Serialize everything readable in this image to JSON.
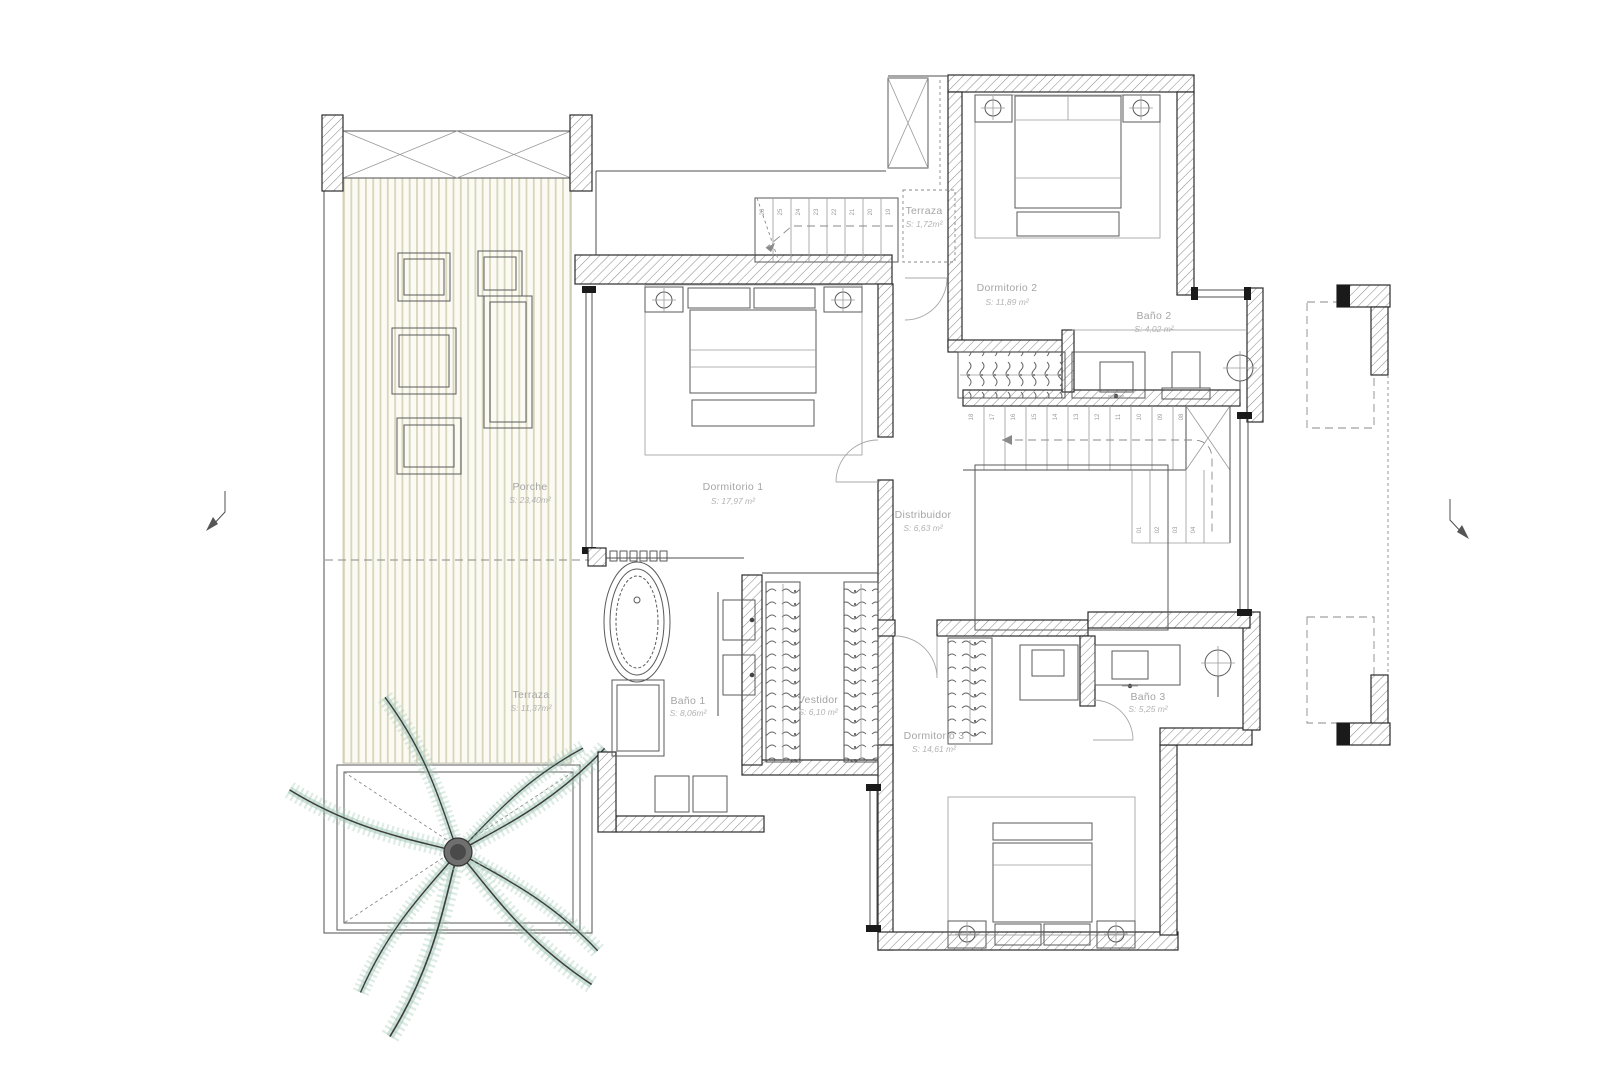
{
  "plan": {
    "rooms": [
      {
        "id": "porche",
        "label": "Porche",
        "area": "S: 23,40m²"
      },
      {
        "id": "terraza-izq",
        "label": "Terraza",
        "area": "S: 11,37m²"
      },
      {
        "id": "dormitorio-1",
        "label": "Dormitorio 1",
        "area": "S: 17,97 m²"
      },
      {
        "id": "bano-1",
        "label": "Baño 1",
        "area": "S: 8,06m²"
      },
      {
        "id": "vestidor",
        "label": "Vestidor",
        "area": "S: 6,10 m²"
      },
      {
        "id": "distribuidor",
        "label": "Distribuidor",
        "area": "S: 6,63 m²"
      },
      {
        "id": "terraza-sup",
        "label": "Terraza",
        "area": "S: 1,72m²"
      },
      {
        "id": "dormitorio-2",
        "label": "Dormitorio 2",
        "area": "S: 11,89 m²"
      },
      {
        "id": "bano-2",
        "label": "Baño 2",
        "area": "S: 4,02 m²"
      },
      {
        "id": "dormitorio-3",
        "label": "Dormitorio 3",
        "area": "S: 14,61 m²"
      },
      {
        "id": "bano-3",
        "label": "Baño 3",
        "area": "S: 5,25 m²"
      }
    ],
    "stairs": {
      "exterior_steps": [
        "26",
        "25",
        "24",
        "23",
        "22",
        "21",
        "20",
        "19"
      ],
      "upper_flight_steps": [
        "18",
        "17",
        "16",
        "15",
        "14",
        "13",
        "12",
        "11",
        "10",
        "09",
        "08"
      ],
      "lower_flight_steps": [
        "01",
        "02",
        "03",
        "04"
      ]
    },
    "colors": {
      "wall_hatch": "#8f8f8f",
      "deck_stripe": "#d9d5bc",
      "palm_leaf": "#a5cabb",
      "palm_stem": "#3d3d3d",
      "label_text": "#a5a5a5"
    }
  }
}
